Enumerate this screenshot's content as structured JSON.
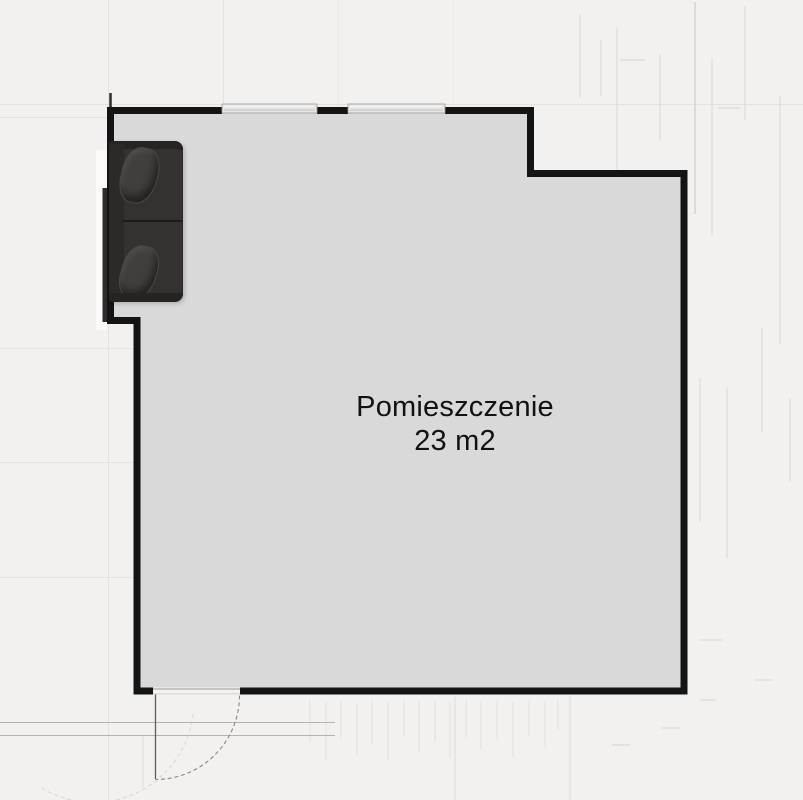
{
  "room": {
    "name": "Pomieszczenie",
    "area": "23 m2"
  },
  "features": {
    "windows": [
      "window-top-left",
      "window-top-right"
    ],
    "door": "door-bottom-left-with-swing-arc",
    "furniture": [
      "sofa-top-left"
    ]
  },
  "colors": {
    "background": "#f2f1ef",
    "room_fill": "#d9d9d9",
    "wall": "#141414",
    "sofa_body": "#2e2b2a",
    "sofa_pillow": "#423e3d",
    "window_fill": "#e6e6e6",
    "door_arc": "#8a8886",
    "label_text": "#121212",
    "grid_line": "#e5e2de"
  }
}
